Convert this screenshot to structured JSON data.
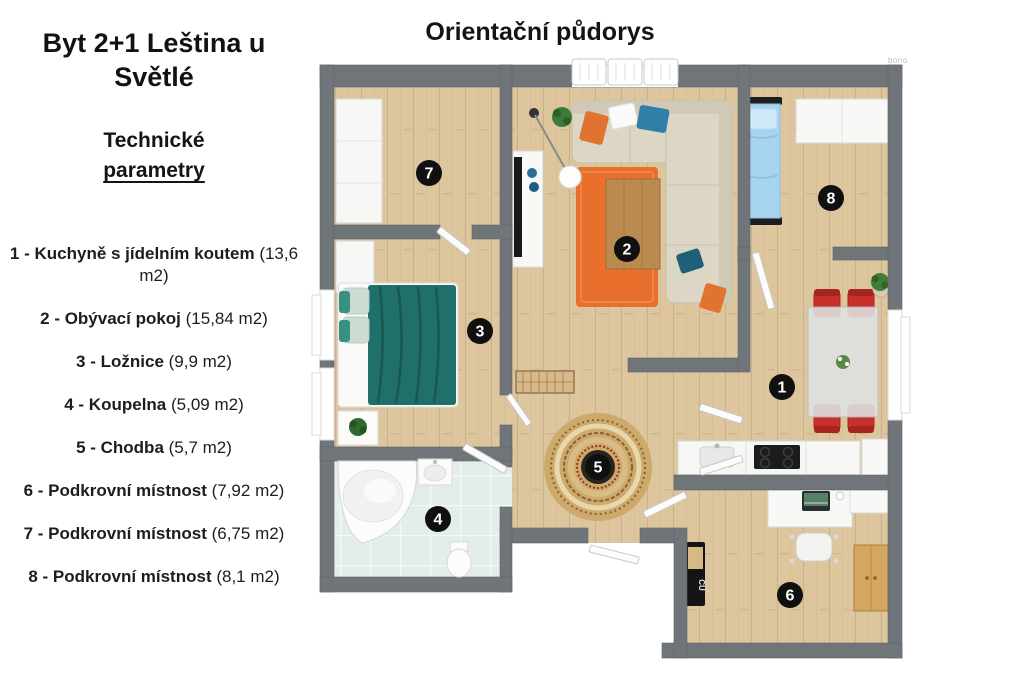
{
  "page": {
    "title": "Byt 2+1 Leština u Světlé",
    "tech_line1": "Technické",
    "tech_line2": "parametry",
    "plan_title": "Orientační půdorys",
    "watermark": "bono"
  },
  "legend": {
    "items": [
      {
        "label": "1 - Kuchyně s jídelním koutem",
        "area": "(13,6 m2)"
      },
      {
        "label": "2 - Obývací pokoj",
        "area": "(15,84 m2)"
      },
      {
        "label": "3 - Ložnice",
        "area": "(9,9 m2)"
      },
      {
        "label": "4 - Koupelna",
        "area": "(5,09 m2)"
      },
      {
        "label": "5 - Chodba",
        "area": "(5,7 m2)"
      },
      {
        "label": "6 - Podkrovní místnost",
        "area": "(7,92 m2)"
      },
      {
        "label": "7 - Podkrovní místnost",
        "area": "(6,75 m2)"
      },
      {
        "label": "8 - Podkrovní místnost",
        "area": "(8,1 m2)"
      }
    ]
  },
  "floorplan": {
    "markers": [
      {
        "number": "1",
        "x": 472,
        "y": 332
      },
      {
        "number": "2",
        "x": 317,
        "y": 194
      },
      {
        "number": "3",
        "x": 170,
        "y": 276
      },
      {
        "number": "4",
        "x": 128,
        "y": 464
      },
      {
        "number": "5",
        "x": 288,
        "y": 412
      },
      {
        "number": "6",
        "x": 480,
        "y": 540
      },
      {
        "number": "7",
        "x": 119,
        "y": 118
      },
      {
        "number": "8",
        "x": 521,
        "y": 143
      }
    ],
    "keyboard_label": "CU"
  },
  "colors": {
    "wall": "#70757a",
    "wood_floor": "#ddc69e",
    "bath_tile": "#e3eee8",
    "accent_orange": "#e8702c",
    "teal_blanket": "#20706a",
    "blue_bed": "#a6d4ef",
    "red_chair": "#c8302c",
    "marker": "#101010"
  }
}
